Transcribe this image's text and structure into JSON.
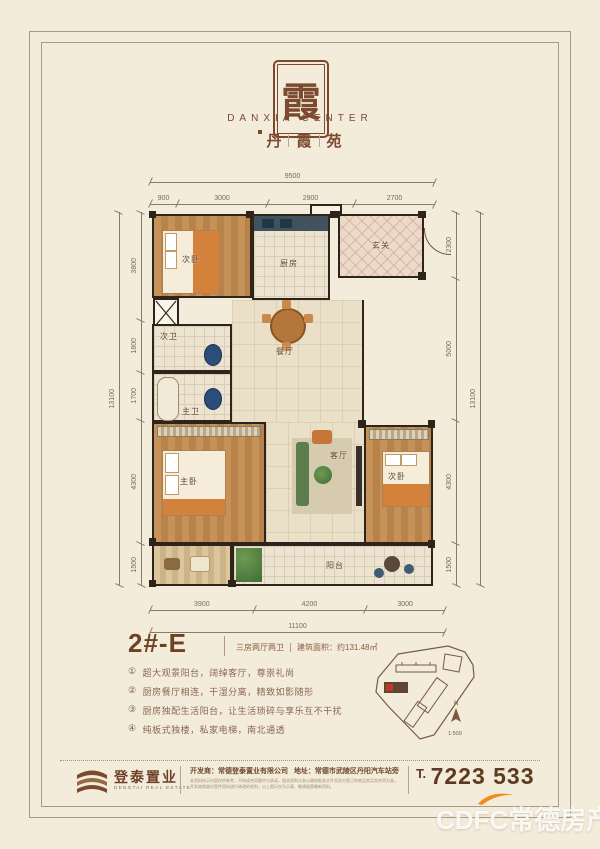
{
  "logo": {
    "seal_char": "霞",
    "name_en": "DANXIA CENTER",
    "cn": [
      "丹",
      "霞",
      "苑"
    ]
  },
  "floorplan": {
    "rooms": {
      "bedroom_tl": "次卧",
      "kitchen": "厨房",
      "foyer": "玄关",
      "bath_second": "次卫",
      "bath_master": "主卫",
      "dining": "餐厅",
      "master": "主卧",
      "living": "客厅",
      "bedroom_r": "次卧",
      "balcony": "阳台"
    },
    "dims": {
      "top_total": "9500",
      "top": [
        "900",
        "3000",
        "2900",
        "2700"
      ],
      "bottom": [
        "3900",
        "4200",
        "3000"
      ],
      "bottom_total": "11100",
      "left": [
        "3800",
        "1800",
        "1700",
        "4300",
        "1500"
      ],
      "left_total": "13100",
      "right": [
        "2300",
        "5000",
        "4300",
        "1500"
      ],
      "right_total": "13100"
    }
  },
  "unit": {
    "code": "2#-E",
    "spec": "三房两厅两卫",
    "area": "建筑面积：约131.48㎡"
  },
  "features": {
    "items": [
      {
        "marker": "①",
        "text": "超大观景阳台，阔绰客厅，尊崇礼尚"
      },
      {
        "marker": "②",
        "text": "厨房餐厅相连，干湿分离，精致如影随形"
      },
      {
        "marker": "③",
        "text": "厨房独配生活阳台，让生活琐碎与享乐互不干扰"
      },
      {
        "marker": "④",
        "text": "纯板式独楼，私家电梯，南北通透"
      }
    ]
  },
  "siteplan": {
    "north": "N",
    "scale": "1:500"
  },
  "footer": {
    "brand_cn": "登泰置业",
    "brand_en": "DENGTAI REAL ESTATE",
    "developer": "开发商：常德登泰置业有限公司",
    "address": "地址：常德市武陵区丹阳汽车站旁",
    "disclaimer1": "本资料所示内容仅供参考，不构成合同要约与承诺，相关权利义务以政府批准文件及双方签订的商品房买卖合同为准。",
    "disclaimer2": "开发商保留对宣传资料进行修改的权利，以上图示仅为示意，敬请留意最新资料。",
    "phone_prefix": "T.",
    "phone": "7223 533"
  },
  "watermark": {
    "text": "CDFC常德房产"
  },
  "colors": {
    "accent": "#7c4a2f",
    "wall": "#2e241c",
    "orange": "#f08c1e"
  }
}
